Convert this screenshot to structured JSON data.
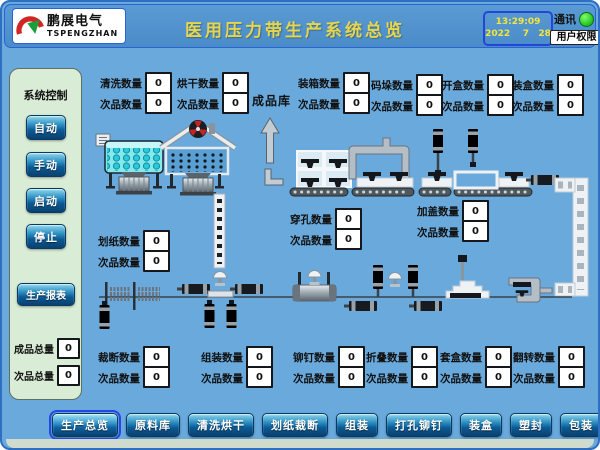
{
  "header": {
    "logo": {
      "brand_cn": "鹏展电气",
      "brand_en": "TSPENGZHAN"
    },
    "title": "医用压力带生产系统总览",
    "clock": {
      "time": "13:29:09",
      "date": "2022    7   28"
    },
    "comm": {
      "label": "通讯",
      "status": "ok"
    },
    "user_button": "用户权限"
  },
  "sidebar": {
    "title": "系统控制",
    "buttons": [
      {
        "label": "自动"
      },
      {
        "label": "手动"
      },
      {
        "label": "启动"
      },
      {
        "label": "停止"
      }
    ],
    "report_button": "生产报表",
    "totals": [
      {
        "label": "成品总量",
        "value": "0"
      },
      {
        "label": "次品总量",
        "value": "0"
      }
    ]
  },
  "plant": {
    "warehouse_label": "成品库",
    "counters": [
      {
        "label": "清洗数量",
        "value": "0",
        "defect_label": "次品数量",
        "defect_value": "0"
      },
      {
        "label": "烘干数量",
        "value": "0",
        "defect_label": "次品数量",
        "defect_value": "0"
      },
      {
        "label": "装箱数量",
        "value": "0",
        "defect_label": "次品数量",
        "defect_value": "0"
      },
      {
        "label": "码垛数量",
        "value": "0",
        "defect_label": "次品数量",
        "defect_value": "0"
      },
      {
        "label": "开盒数量",
        "value": "0",
        "defect_label": "次品数量",
        "defect_value": "0"
      },
      {
        "label": "装盒数量",
        "value": "0",
        "defect_label": "次品数量",
        "defect_value": "0"
      },
      {
        "label": "穿孔数量",
        "value": "0",
        "defect_label": "次品数量",
        "defect_value": "0"
      },
      {
        "label": "加盖数量",
        "value": "0",
        "defect_label": "次品数量",
        "defect_value": "0"
      },
      {
        "label": "划纸数量",
        "value": "0",
        "defect_label": "次品数量",
        "defect_value": "0"
      },
      {
        "label": "裁断数量",
        "value": "0",
        "defect_label": "次品数量",
        "defect_value": "0"
      },
      {
        "label": "组装数量",
        "value": "0",
        "defect_label": "次品数量",
        "defect_value": "0"
      },
      {
        "label": "铆钉数量",
        "value": "0",
        "defect_label": "次品数量",
        "defect_value": "0"
      },
      {
        "label": "折叠数量",
        "value": "0",
        "defect_label": "次品数量",
        "defect_value": "0"
      },
      {
        "label": "套盒数量",
        "value": "0",
        "defect_label": "次品数量",
        "defect_value": "0"
      },
      {
        "label": "翻转数量",
        "value": "0",
        "defect_label": "次品数量",
        "defect_value": "0"
      }
    ]
  },
  "nav": {
    "tabs": [
      {
        "label": "生产总览",
        "active": true
      },
      {
        "label": "原料库",
        "active": false
      },
      {
        "label": "清洗烘干",
        "active": false
      },
      {
        "label": "划纸裁断",
        "active": false
      },
      {
        "label": "组装",
        "active": false
      },
      {
        "label": "打孔铆钉",
        "active": false
      },
      {
        "label": "装盒",
        "active": false
      },
      {
        "label": "塑封",
        "active": false
      },
      {
        "label": "包装",
        "active": false
      },
      {
        "label": "成品暂存",
        "active": false
      }
    ]
  },
  "colors": {
    "background_blue": "#69a9dc",
    "header_blue": "#5a9bd4",
    "title_yellow": "#e6d54e",
    "status_green": "#22c122",
    "sidebar_green": "#d9ecd5",
    "button_blue": "#0c5a94",
    "active_outline_blue": "#2348e6"
  }
}
